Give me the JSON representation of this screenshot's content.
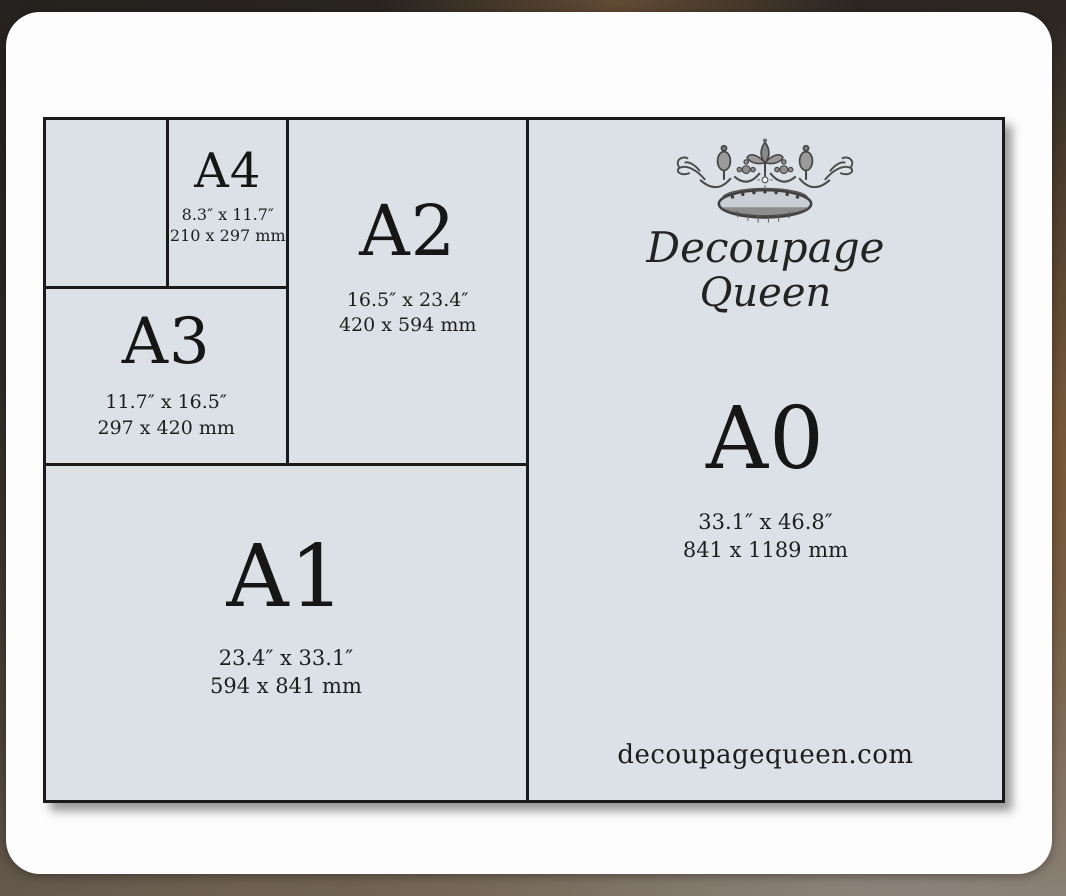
{
  "chart": {
    "panels": {
      "a4": {
        "label": "A4",
        "inches": "8.3″ x 11.7″",
        "mm": "210 x 297 mm"
      },
      "a2": {
        "label": "A2",
        "inches": "16.5″ x 23.4″",
        "mm": "420 x 594 mm"
      },
      "a3": {
        "label": "A3",
        "inches": "11.7″ x 16.5″",
        "mm": "297 x 420 mm"
      },
      "a1": {
        "label": "A1",
        "inches": "23.4″ x 33.1″",
        "mm": "594 x 841 mm"
      },
      "a0": {
        "label": "A0",
        "inches": "33.1″ x 46.8″",
        "mm": "841 x 1189 mm"
      }
    },
    "brand": {
      "line1": "Decoupage",
      "line2": "Queen",
      "website": "decoupagequeen.com"
    },
    "colors": {
      "panel_fill": "#dbe1e6",
      "line": "#1a1a1a",
      "card": "#fdfdfd",
      "backdrop_brown": "#6e5138"
    },
    "icons": {
      "crown": "crown-icon"
    }
  }
}
